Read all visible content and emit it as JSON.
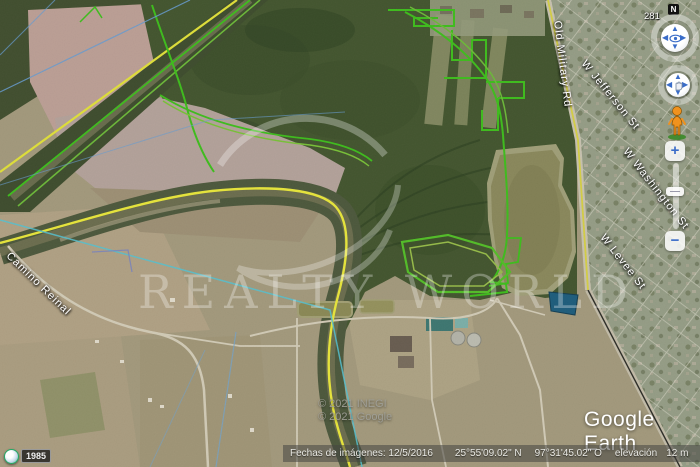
{
  "app": {
    "logo_text": "Google Earth"
  },
  "navigation": {
    "compass_heading": "281",
    "north_label": "N",
    "zoom_in_label": "+",
    "zoom_out_label": "−"
  },
  "historical_imagery": {
    "year_badge": "1985"
  },
  "watermark": {
    "text": "REALTY WORLD"
  },
  "street_labels": [
    {
      "text": "Old Military Rd"
    },
    {
      "text": "W Jefferson St"
    },
    {
      "text": "W Washington St"
    },
    {
      "text": "W Levee St"
    },
    {
      "text": "Camino Reinal"
    }
  ],
  "copyright": {
    "line1": "© 2021 INEGI",
    "line2": "© 2021 Google"
  },
  "status_bar": {
    "imagery_date": "Fechas de imágenes: 12/5/2016",
    "latitude": "25°55'09.02\" N",
    "longitude": "97°31'45.02\" O",
    "elevation_label": "elevación",
    "elevation_value": "12 m",
    "eye_altitude_label": "alt. ojo",
    "eye_altitude_value": "2.31 km"
  },
  "colors": {
    "border_line_yellow": "#eeee3c",
    "parcel_line_green": "#3fc41c",
    "parcel_line_green_light": "#8cc83e",
    "survey_line_cyan": "#57c8d8",
    "survey_line_blue": "#6aa1d8",
    "pond_water_blue": "#1d5f80",
    "nav_arrow_blue": "#3a6cc8",
    "pegman_orange": "#f0921e"
  }
}
